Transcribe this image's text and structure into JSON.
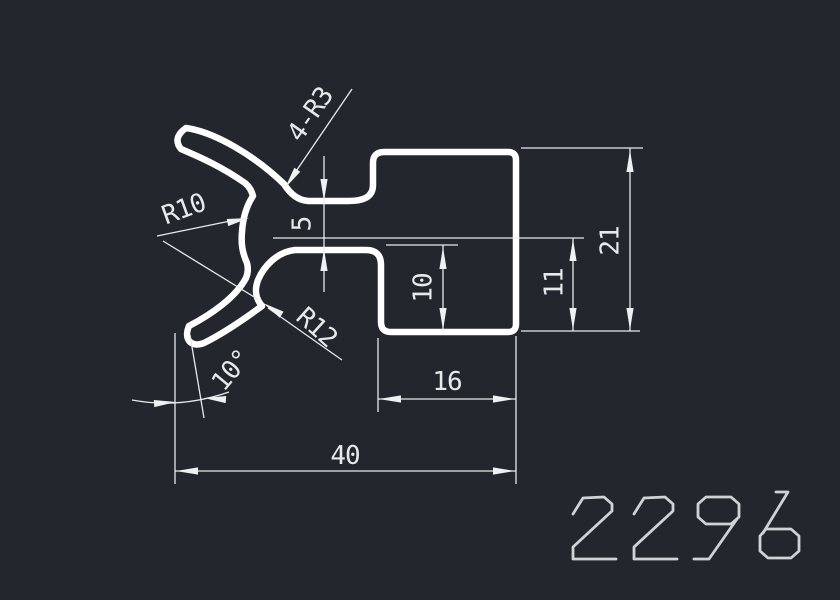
{
  "app": {
    "type": "cad-drawing-view"
  },
  "canvas": {
    "background": "#23272d",
    "profile_line_color": "#ffffff",
    "dimension_line_color": "#e7e9eb",
    "part_number_color": "#cfd3d6"
  },
  "part": {
    "number": "2296"
  },
  "dimensions": {
    "fillet_note": "4-R3",
    "inner_radius": "R10",
    "outer_radius": "R12",
    "neck_thickness": "5",
    "lip_angle": "10°",
    "step_depth": "10",
    "right_step_height": "11",
    "total_height": "21",
    "block_width": "16",
    "total_width": "40"
  }
}
